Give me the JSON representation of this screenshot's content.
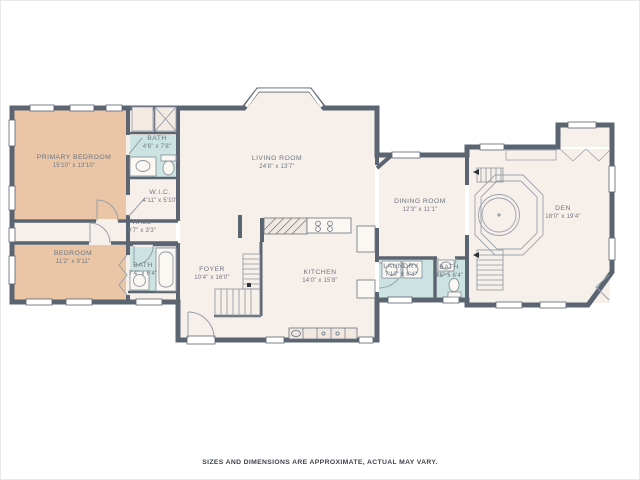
{
  "meta": {
    "type": "residential floor plan"
  },
  "palette": {
    "background": "#ffffff",
    "wall": "#5b6572",
    "floor": "#f7efe9",
    "bedroom_fill": "#eac6a6",
    "bath_fill": "#cbe3e1",
    "fixture_line": "#97a0ab",
    "label_text": "#6e7682"
  },
  "rooms": [
    {
      "id": "primary-bedroom",
      "name": "PRIMARY BEDROOM",
      "dims": "15'10\" x 13'10\""
    },
    {
      "id": "bath-primary",
      "name": "BATH",
      "dims": "4'6\" x 7'8\""
    },
    {
      "id": "wic",
      "name": "W.I.C.",
      "dims": "4'11\" x 5'10\""
    },
    {
      "id": "hall",
      "name": "HALL",
      "dims": "9'7\" x 3'3\""
    },
    {
      "id": "bedroom",
      "name": "BEDROOM",
      "dims": "11'2\" x 9'11\""
    },
    {
      "id": "bath-hall",
      "name": "BATH",
      "dims": "7'4\" x 6'4\""
    },
    {
      "id": "living-room",
      "name": "LIVING ROOM",
      "dims": "24'8\" x 13'7\""
    },
    {
      "id": "foyer",
      "name": "FOYER",
      "dims": "10'4\" x 16'0\""
    },
    {
      "id": "kitchen",
      "name": "KITCHEN",
      "dims": "14'0\" x 15'8\""
    },
    {
      "id": "dining-room",
      "name": "DINING ROOM",
      "dims": "12'3\" x 11'1\""
    },
    {
      "id": "laundry",
      "name": "LAUNDRY",
      "dims": "7'10\" x 6'4\""
    },
    {
      "id": "bath-powder",
      "name": "BATH",
      "dims": "4'5\" x 6'4\""
    },
    {
      "id": "den",
      "name": "DEN",
      "dims": "18'0\" x 19'4\""
    }
  ],
  "footer": {
    "disclaimer": "SIZES AND DIMENSIONS ARE APPROXIMATE, ACTUAL MAY VARY."
  }
}
